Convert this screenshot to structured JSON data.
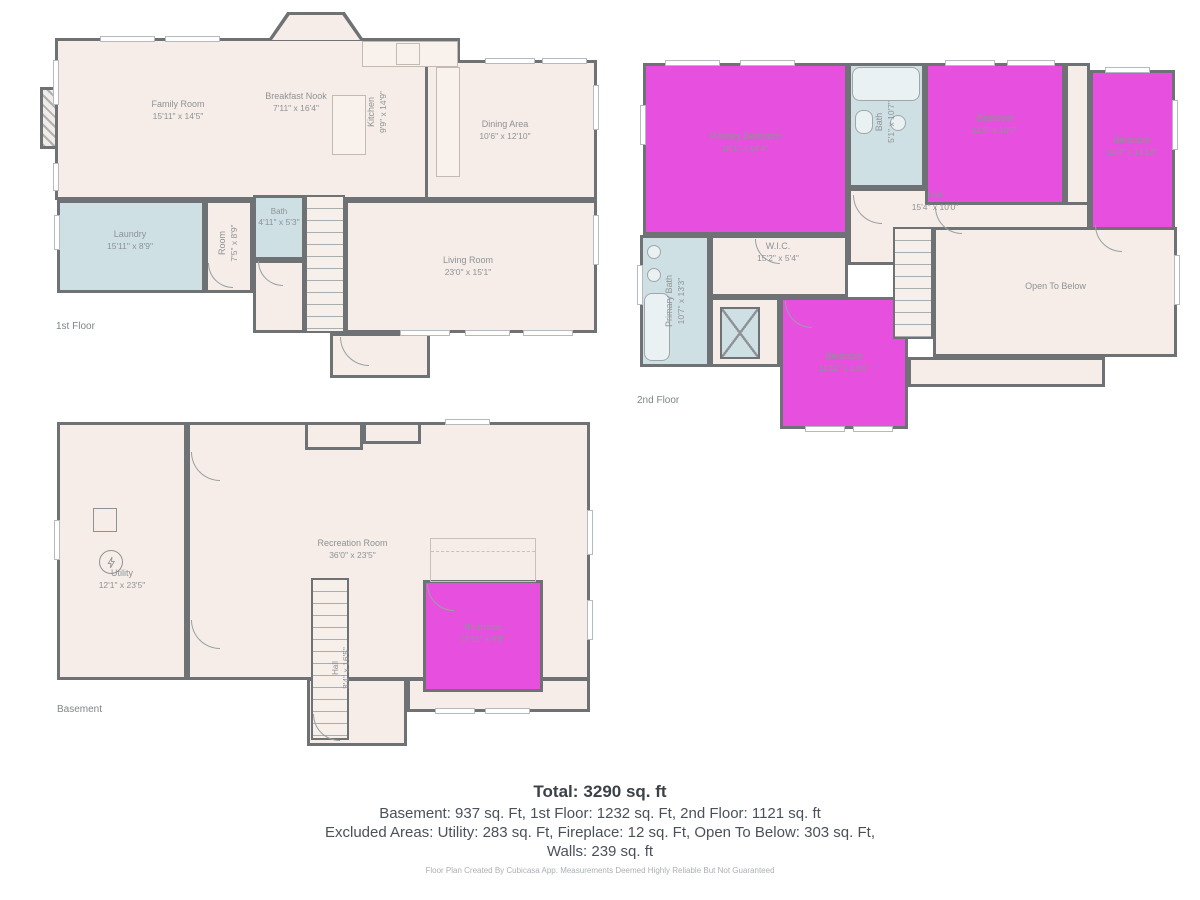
{
  "palette": {
    "wall": "#6e7275",
    "floor": "#f6ede8",
    "wet_room": "#cfe0e4",
    "bedroom": "#e750de",
    "label_text": "#8d9296"
  },
  "floors": [
    {
      "label": "1st Floor",
      "rooms": [
        {
          "name": "Family Room",
          "dims": "15'11\" x 14'5\""
        },
        {
          "name": "Breakfast Nook",
          "dims": "7'11\" x 16'4\""
        },
        {
          "name": "Kitchen",
          "dims": "9'9\" x 14'9\""
        },
        {
          "name": "Dining Area",
          "dims": "10'6\" x 12'10\""
        },
        {
          "name": "Laundry",
          "dims": "15'11\" x 8'9\""
        },
        {
          "name": "Room",
          "dims": "7'5\" x 8'9\""
        },
        {
          "name": "Bath",
          "dims": "4'11\" x 5'3\""
        },
        {
          "name": "Living Room",
          "dims": "23'0\" x 15'1\""
        }
      ]
    },
    {
      "label": "2nd Floor",
      "rooms": [
        {
          "name": "Primary Bedroom",
          "dims": "14'1\" x 14'4\""
        },
        {
          "name": "Bath",
          "dims": "5'1\" x 10'7\""
        },
        {
          "name": "Bedroom",
          "dims": "11'5\" x 10'7\""
        },
        {
          "name": "Bedroom",
          "dims": "10'4\" x 14'10\""
        },
        {
          "name": "Hall",
          "dims": "15'4\" x 10'0\""
        },
        {
          "name": "Primary Bath",
          "dims": "10'7\" x 13'3\""
        },
        {
          "name": "W.I.C.",
          "dims": "15'2\" x 5'4\""
        },
        {
          "name": "Bedroom",
          "dims": "11'11\" x 13'6\""
        },
        {
          "name": "Open To Below",
          "dims": ""
        }
      ]
    },
    {
      "label": "Basement",
      "rooms": [
        {
          "name": "Utility",
          "dims": "12'1\" x 23'5\""
        },
        {
          "name": "Recreation Room",
          "dims": "36'0\" x 23'5\""
        },
        {
          "name": "Hall",
          "dims": "3'4\" x 16'5\""
        },
        {
          "name": "Bedroom",
          "dims": "11'11\" x 9'6\""
        }
      ]
    }
  ],
  "summary": {
    "total_label": "Total:",
    "total_value": "3290 sq. ft",
    "line2": "Basement: 937 sq. Ft, 1st Floor: 1232 sq. Ft, 2nd Floor: 1121 sq. ft",
    "line3": "Excluded Areas: Utility: 283 sq. Ft, Fireplace: 12 sq. Ft, Open To Below: 303 sq. Ft,",
    "line4": "Walls: 239 sq. ft"
  },
  "footer": "Floor Plan Created By Cubicasa App. Measurements Deemed Highly Reliable But Not Guaranteed"
}
